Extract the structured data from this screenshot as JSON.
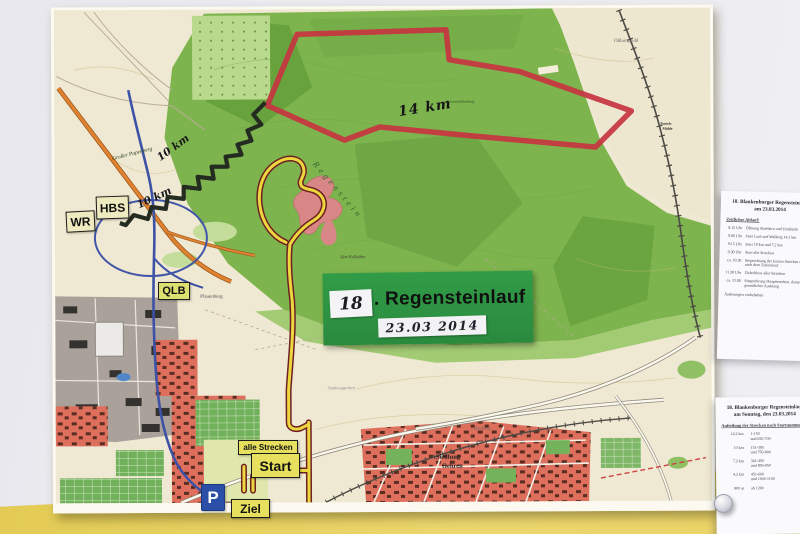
{
  "sign": {
    "number": "18",
    "title": ". Regensteinlauf",
    "date": "23.03 2014"
  },
  "markers": {
    "wr": "WR",
    "hbs": "HBS",
    "qlb": "QLB",
    "alle_strecken": "alle Strecken",
    "start": "Start",
    "ziel": "Ziel",
    "parking": "P"
  },
  "handwriting": {
    "red_route_distance": "14 km",
    "black_route_distance_a": "10 km",
    "black_route_distance_b": "10 km"
  },
  "map_labels": {
    "papenberg": "Großer Papenberg",
    "regenstein": "Regenstein",
    "kalkoefen": "Alte Kalköfen",
    "plauenberg": "Plauenberg",
    "elevation": "452",
    "siedlung_1": "Siedlung",
    "siedlung_2": "Gehren",
    "osslumpfuhl": "Oßlumpfuhl",
    "pulverberg": "Pulvermühlenberg",
    "stadtweggraben": "Stadtweggraben",
    "muehle_1": "Bartels",
    "muehle_2": "Mühle",
    "heidberg": "Heidberg"
  },
  "paper_schedule": {
    "title_line1": "18. Blankenburger Regensteinlauf",
    "title_line2": "am 23.03.2014",
    "subhead": "Zeitlicher Ablauf:",
    "rows": [
      {
        "time": "8.15 Uhr",
        "text": "Öffnung Startbüro und Umkleide"
      },
      {
        "time": "9.00 Uhr",
        "text": "Start Lauf und Walking 14,2 km"
      },
      {
        "time": "9.15 Uhr",
        "text": "Start 10 km und 7,2 km"
      },
      {
        "time": "9.30 Uhr",
        "text": "Start alle Strecken"
      },
      {
        "time": "ca. 10.30",
        "text": "Siegerehrung der kurzen Strecken direkt nach dem Zieleinlauf"
      },
      {
        "time": "11.30 Uhr",
        "text": "Zielschluss aller Strecken"
      },
      {
        "time": "ca. 12.00",
        "text": "Siegerehrung Hauptstrecken, danach gemütlicher Ausklang"
      }
    ],
    "footer": "Änderungen vorbehalten"
  },
  "paper_numbers": {
    "title_line1": "18. Blankenburger Regensteinlauf",
    "title_line2": "am Sonntag, den 23.03.2014",
    "subhead": "Aufteilung der Strecken nach Startnummern",
    "rows": [
      {
        "dist": "14,2 km",
        "nums": "1-150",
        "extra": "und 650-700"
      },
      {
        "dist": "10 km",
        "nums": "151-300",
        "extra": "und 750-800"
      },
      {
        "dist": "7,2 km",
        "nums": "301-450",
        "extra": "und 850-950"
      },
      {
        "dist": "4,2 km",
        "nums": "451-600",
        "extra": "und 1000-1150"
      },
      {
        "dist": "800 m",
        "nums": "ab 1200",
        "extra": ""
      }
    ]
  },
  "colors": {
    "sign_green": "#2e9444",
    "wall_yellow": "#e8d164",
    "route_red": "#c73440",
    "route_black": "#242b21",
    "route_yellow": "#ecd73e",
    "marker_yellow": "#e7e05e",
    "parking_blue": "#2b4ea6"
  }
}
